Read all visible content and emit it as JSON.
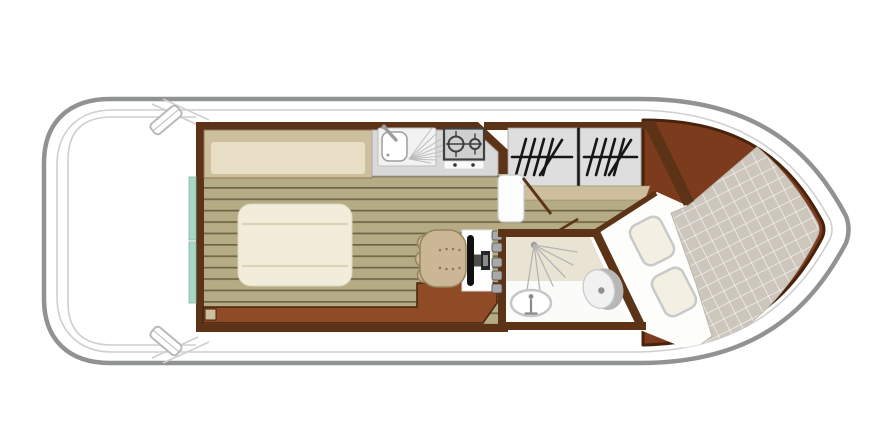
{
  "diagram": {
    "type": "boat-floor-plan",
    "orientation": "bow-left-stern-right",
    "rooms": [
      {
        "id": "bow-deck",
        "objects": [
          "cleat-top",
          "cleat-bottom",
          "bow-seat-line"
        ]
      },
      {
        "id": "saloon",
        "objects": [
          "settee",
          "dinette-table",
          "sliding-door",
          "helm-chair",
          "steering-wheel",
          "helm-console",
          "storage-cabinet"
        ]
      },
      {
        "id": "galley",
        "objects": [
          "sink",
          "faucet",
          "drainboard",
          "stove-two-burners",
          "stove-knobs"
        ]
      },
      {
        "id": "bunk-cabin",
        "objects": [
          "bunk-left",
          "bunk-right",
          "bunk-divider",
          "shelf",
          "cabin-door",
          "door-swing"
        ]
      },
      {
        "id": "bathroom",
        "objects": [
          "shower",
          "washbasin",
          "toilet",
          "door-swing"
        ]
      },
      {
        "id": "aft-cabin",
        "objects": [
          "double-bed-sheet",
          "double-bed-quilt",
          "pillow-1",
          "pillow-2",
          "aft-deck"
        ]
      }
    ],
    "counts": {
      "bunks": 2,
      "pillows": 2,
      "cleats": 2,
      "stove_burners": 2
    }
  },
  "colors": {
    "hull_outline": "#909294",
    "deck_line": "#cfcfcf",
    "cleat": "#b9b9b9",
    "wall": "#5c3317",
    "wall_dark": "#47230d",
    "floor_tan": "#b5ab84",
    "floor_stripe": "#6e6546",
    "settee_frame": "#cdbf9d",
    "settee_cushion": "#e9dfc6",
    "counter": "#d9d9d9",
    "counter_border": "#a9a9a9",
    "stove_dark": "#3f3f3f",
    "sliding_door": "#a7d8c4",
    "table": "#f2edda",
    "table_line": "#d9d3b9",
    "cabinet": "#8f4a26",
    "chair": "#cbb795",
    "chair_border": "#97835c",
    "bunk": "#dedede",
    "aft_deck": "#7d3b1d",
    "sheet": "#fdfdfc",
    "quilt": "#cdc6bd",
    "quilt_line": "#ffffff",
    "pillow": "#f3efe2",
    "shower": "#e9e3d3",
    "bath": "#fbfbfa"
  }
}
